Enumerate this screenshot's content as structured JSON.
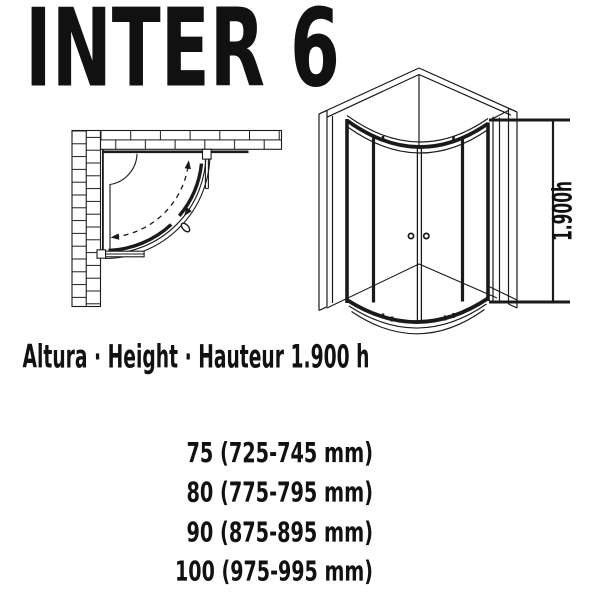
{
  "title": "INTER 6",
  "caption": "Altura · Height · Hauteur 1.900 h",
  "dimension": {
    "label": "1.900h",
    "color": "#2e4a68"
  },
  "sizes": [
    {
      "size": "75",
      "range_mm": "725-745 mm",
      "label": "75 (725-745 mm)"
    },
    {
      "size": "80",
      "range_mm": "775-795 mm",
      "label": "80 (775-795 mm)"
    },
    {
      "size": "90",
      "range_mm": "875-895 mm",
      "label": "90 (875-895 mm)"
    },
    {
      "size": "100",
      "range_mm": "975-995 mm",
      "label": "100 (975-995 mm)"
    }
  ],
  "colors": {
    "line": "#1a1a1a",
    "text": "#111111",
    "background": "#ffffff"
  }
}
